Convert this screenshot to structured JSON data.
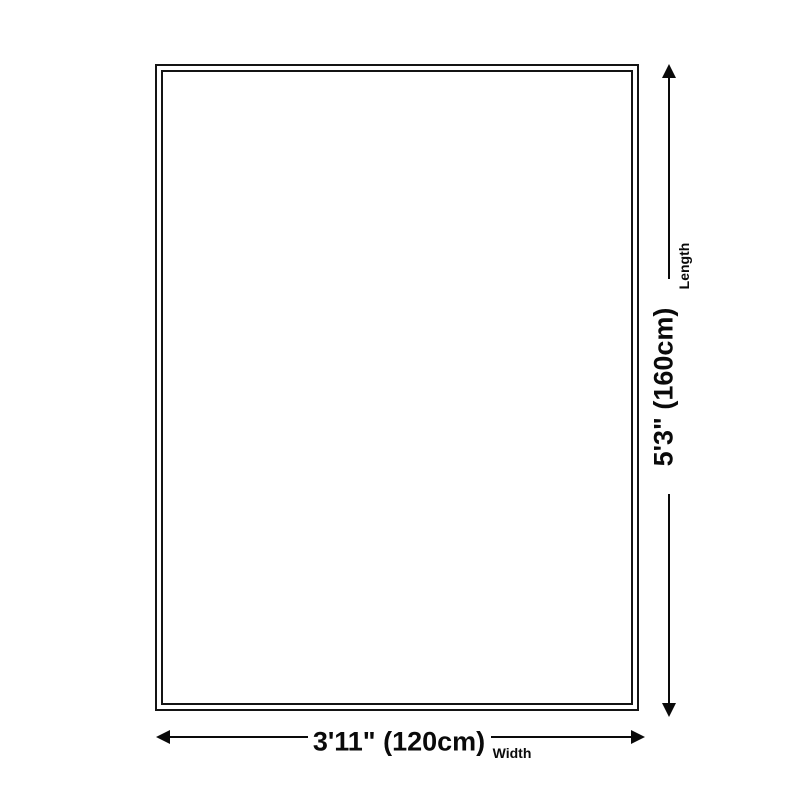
{
  "page": {
    "background_color": "#ffffff",
    "line_color": "#0a0a0a"
  },
  "diagram": {
    "type": "product-size-diagram",
    "shape": "rectangle-double-border",
    "dimensions": {
      "length": {
        "value": "5'3\" (160cm)",
        "label": "Length"
      },
      "width": {
        "value": "3'11\" (120cm)",
        "label": "Width"
      }
    }
  }
}
